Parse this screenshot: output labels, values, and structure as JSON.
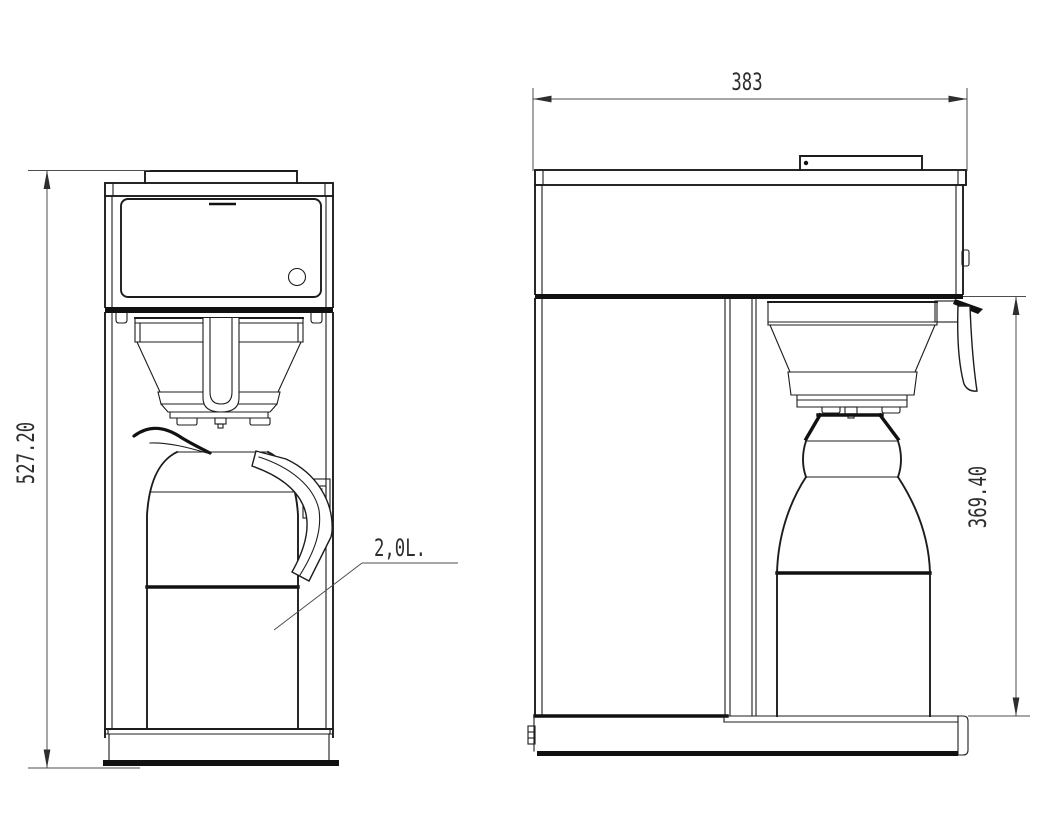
{
  "drawing": {
    "dimensions": {
      "overall_height_mm": "527.20",
      "depth_mm": "383",
      "brew_height_mm": "369.40"
    },
    "labels": {
      "jug_capacity": "2,0L."
    }
  }
}
